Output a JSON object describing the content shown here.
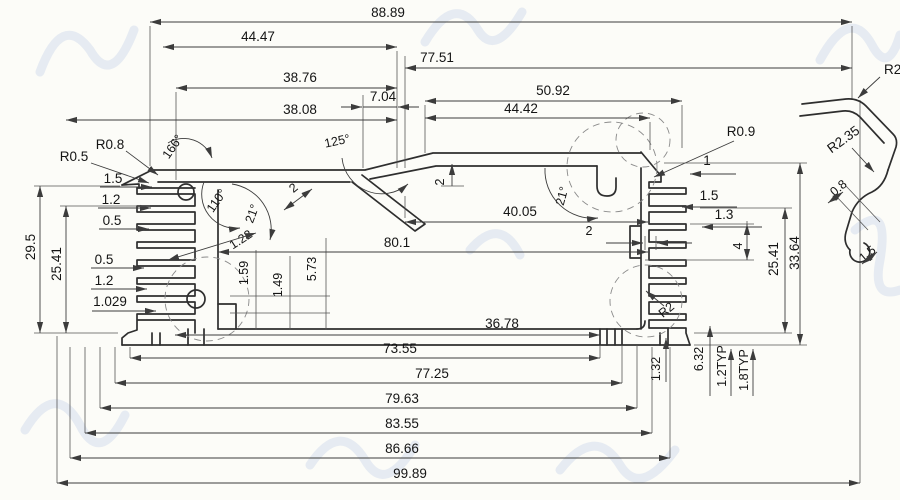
{
  "drawing": {
    "description": "CAD cross-section drawing of an aluminum extrusion enclosure profile with heatsink fins and full dimension annotations",
    "line_color": "#2e2e2e",
    "dimension_color": "#3c3c3c",
    "watermark_color": "#c7d3ea",
    "background": "#fcfcf8"
  },
  "dimensions": {
    "top": {
      "overall": "88.89",
      "left_upper": "44.47",
      "right_upper": "77.51",
      "left_mid": "38.76",
      "notch": "7.04",
      "right_mid": "50.92",
      "left_lower": "38.08",
      "right_lower": "44.42"
    },
    "angles": {
      "left_corner": "166°",
      "left_slant": "110°",
      "left_small": "21°",
      "baffle": "125°",
      "right_corner": "21°"
    },
    "left": {
      "radius_corner": "R0.8",
      "radius_edge": "R0.5",
      "fin_tip": "1.5",
      "fin_pitch": "1.2",
      "fin_gap": "0.5",
      "height_outer": "29.5",
      "height_inner": "25.41",
      "fin_gap2": "0.5",
      "fin_pitch2": "1.2",
      "foot": "1.029"
    },
    "interior": {
      "baffle_thickness": "2",
      "slot_depth": "2",
      "width_upper": "40.05",
      "width_inner": "80.1",
      "hook_gap": "2",
      "baffle_wall": "1.22",
      "step_a": "1.59",
      "step_b": "1.49",
      "step_c": "5.73",
      "width_lower": "36.78"
    },
    "right": {
      "radius_corner": "R0.9",
      "hook_width": "1",
      "fin_tip": "1.5",
      "fin_gap": "1.3",
      "boss_height": "4",
      "height_inner": "25.41",
      "height_outer": "33.64",
      "fillet": "R2"
    },
    "bottom_right": {
      "wall": "1.32",
      "slot": "6.32",
      "typ_a": "1.2TYP",
      "typ_b": "1.8TYP"
    },
    "bottom": {
      "w1": "73.55",
      "w2": "77.25",
      "w3": "79.63",
      "w4": "83.55",
      "w5": "86.66",
      "overall": "99.89"
    },
    "detail": {
      "label": "R2",
      "radius": "R2.35",
      "t_a": "0.8",
      "t_b": "1.5"
    }
  }
}
